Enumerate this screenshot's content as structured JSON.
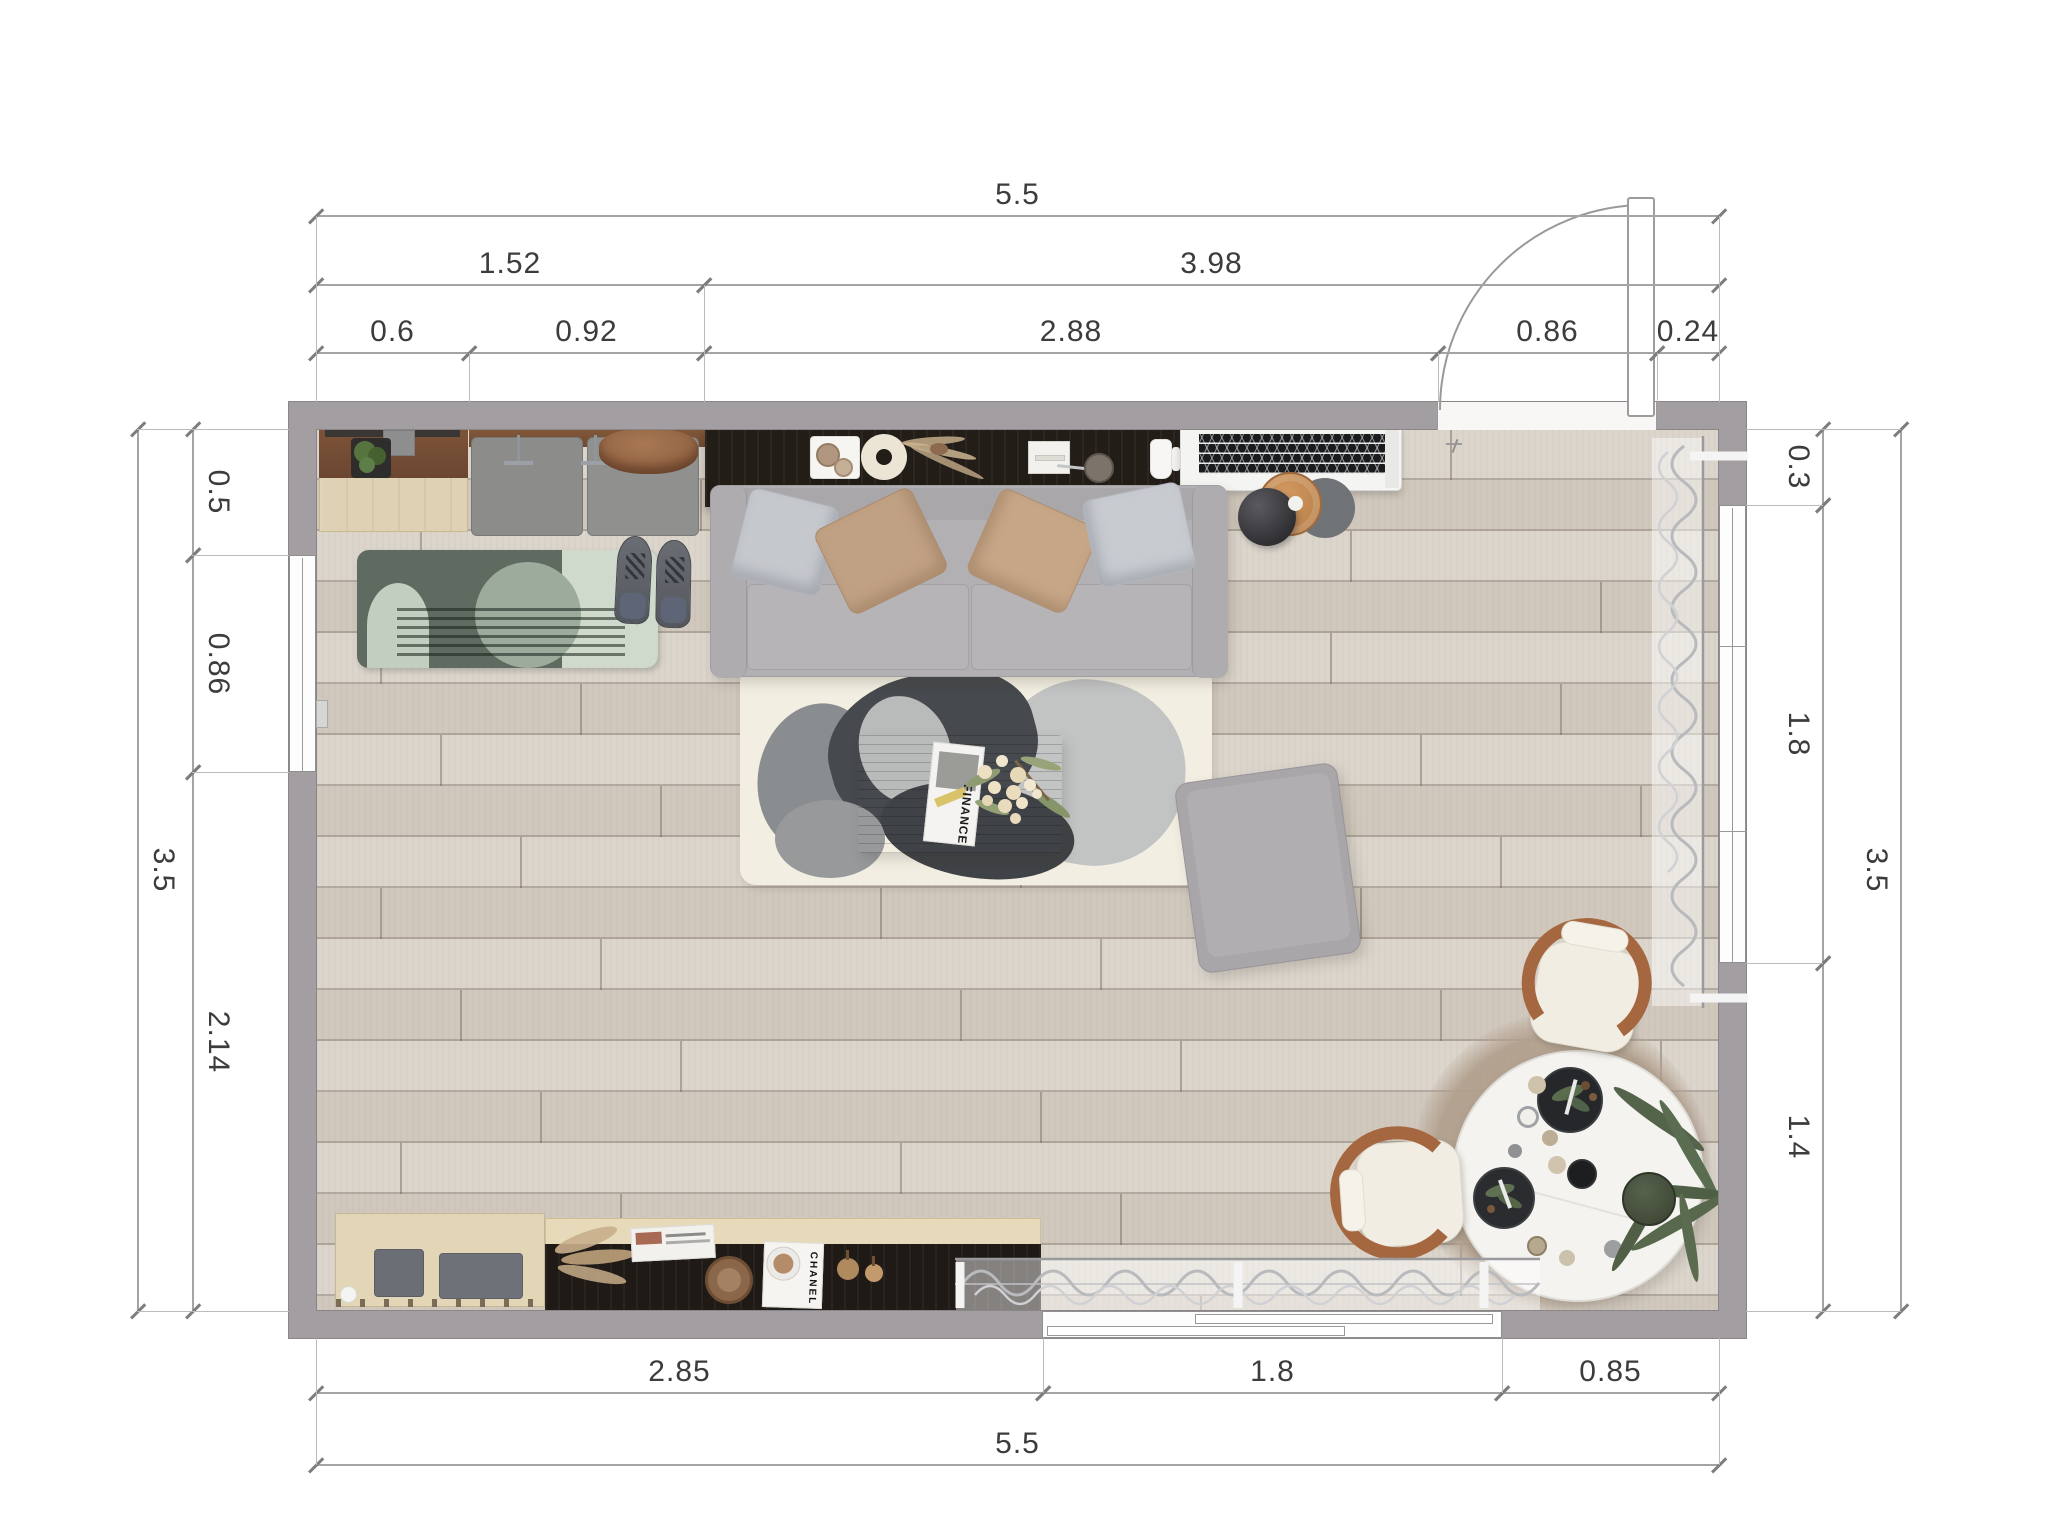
{
  "title": "Living Room Floor Plan",
  "units": "m",
  "dims": {
    "top_overall": "5.5",
    "top_row2": [
      "1.52",
      "3.98"
    ],
    "top_row3": [
      "0.6",
      "0.92",
      "2.88",
      "0.86",
      "0.24"
    ],
    "left_outer": "3.5",
    "left_inner": [
      "0.5",
      "0.86",
      "2.14"
    ],
    "right_outer": "3.5",
    "right_inner": [
      "0.3",
      "1.8",
      "1.4"
    ],
    "bottom_inner": [
      "2.85",
      "1.8",
      "0.85"
    ],
    "bottom_overall": "5.5"
  },
  "texts": {
    "magazine": "FINANCE",
    "book": "CHANEL"
  },
  "colors": {
    "wall": "#a39ea1",
    "floor": "#d5cdc2",
    "sofa": "#b2b0b2",
    "shelf_dark": "#231d18",
    "wood_walnut": "#6e4a33",
    "wood_light": "#e3d6b6",
    "chair_wood": "#a5673f",
    "rug_cream": "#f2eee2",
    "runner_green": "#5f6b60",
    "curtain": "#c9cacd",
    "dining_table": "#f4f3ef",
    "ac_grille": "#1a1b1d"
  }
}
